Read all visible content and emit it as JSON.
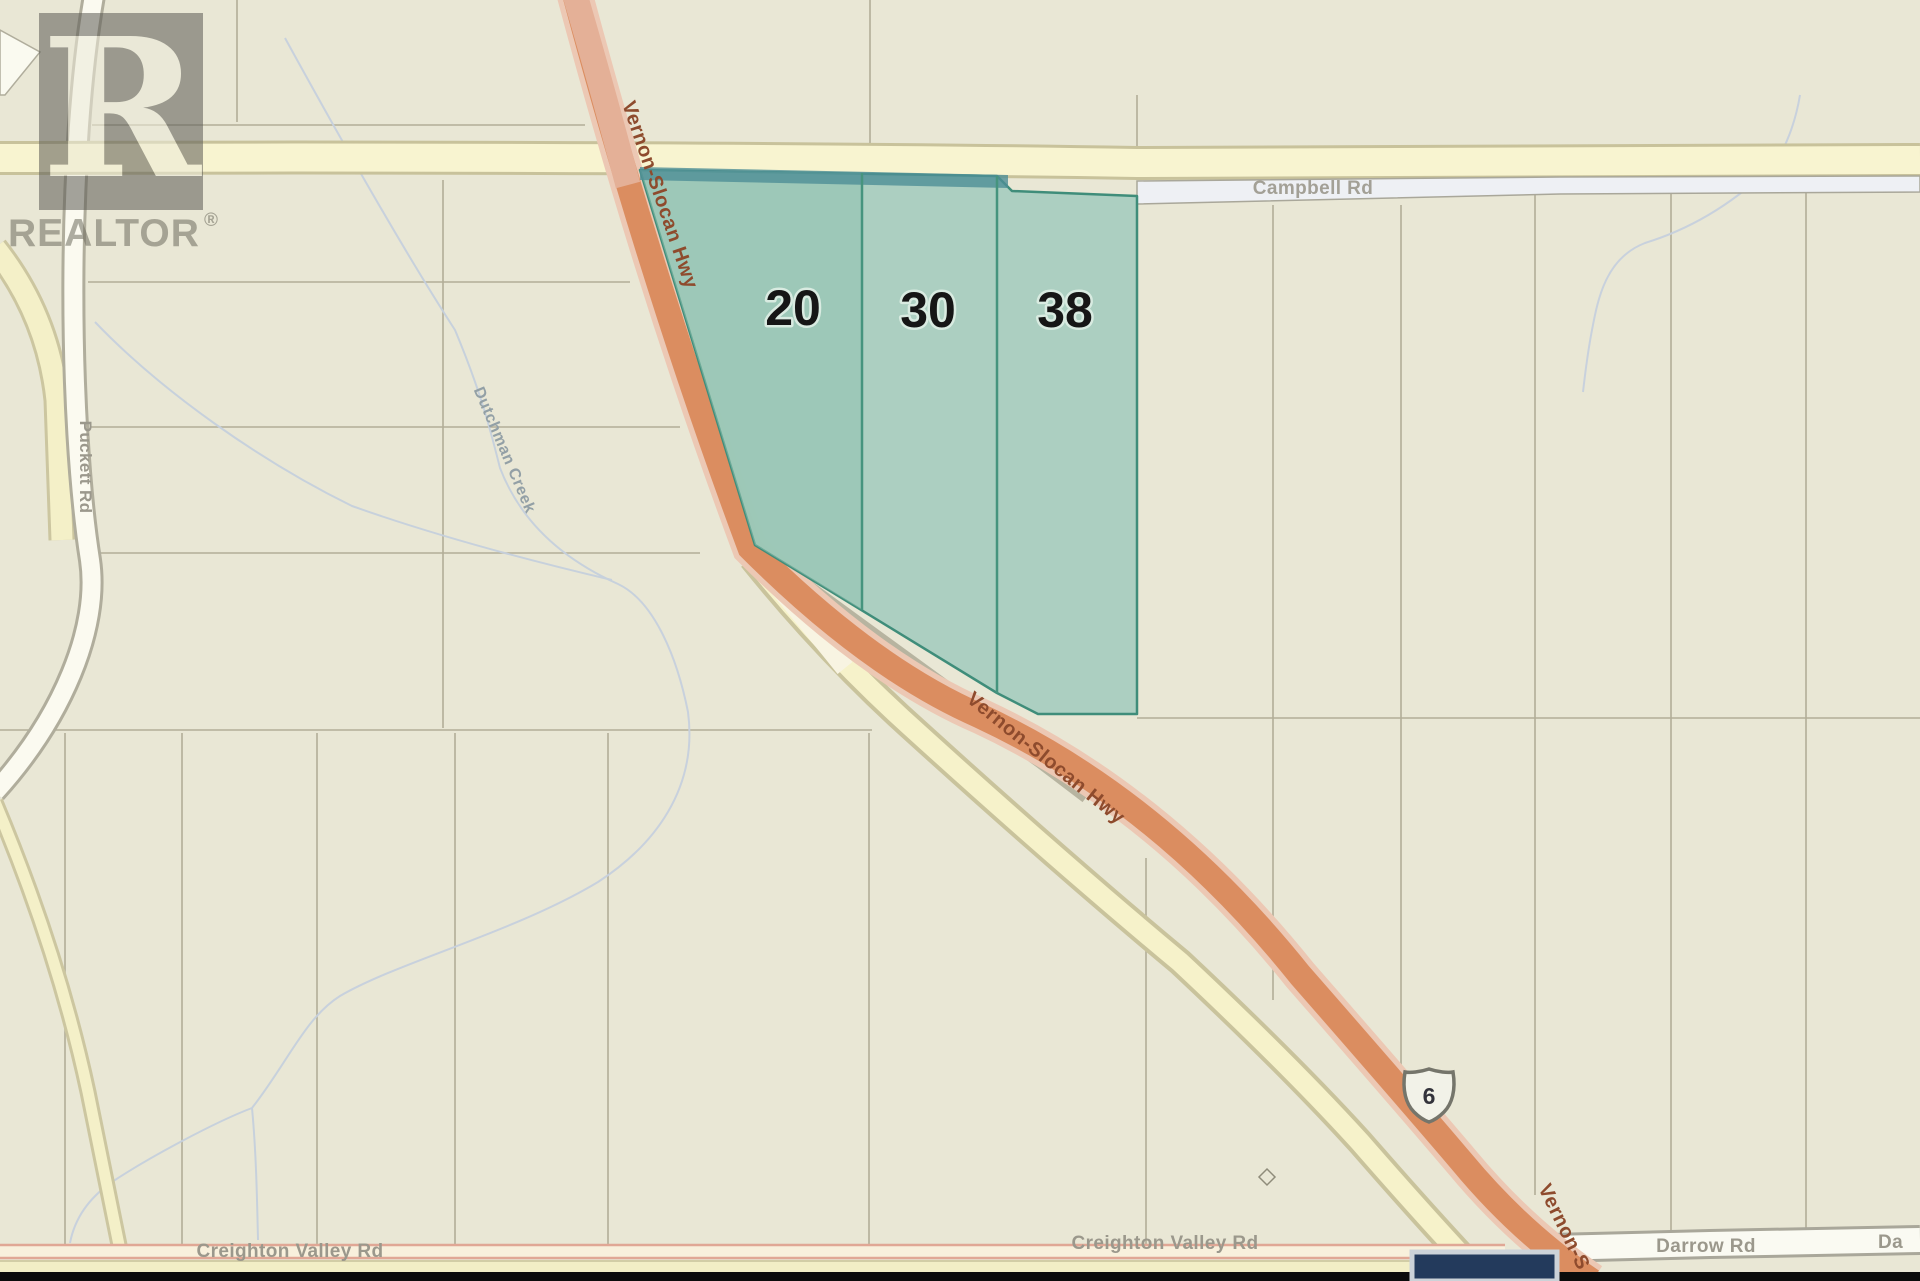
{
  "map": {
    "watermark": {
      "logo_letter": "R",
      "brand": "REALTOR",
      "registered_mark": "®"
    },
    "parcels": {
      "items": [
        {
          "label": "20"
        },
        {
          "label": "30"
        },
        {
          "label": "38"
        }
      ]
    },
    "roads": {
      "campbell": {
        "label": "Campbell Rd"
      },
      "vernon_slocan": {
        "label": "Vernon-Slocan Hwy",
        "label_truncated": "Vernon-S",
        "shield_number": "6"
      },
      "creighton_valley": {
        "label": "Creighton Valley Rd"
      },
      "darrow": {
        "label": "Darrow Rd",
        "label_truncated": "Da"
      },
      "puckett": {
        "label": "Puckett Rd"
      }
    },
    "waterways": {
      "dutchman_creek": {
        "label": "Dutchman Creek"
      }
    },
    "colors": {
      "background": "#e9e7d5",
      "parcel_fill": "#a9cec0",
      "parcel_outline": "#3f8d7a",
      "parcel_top_strip": "#4f8f96",
      "highway_fill": "#db8d60",
      "highway_casing": "#ecc8b4",
      "minor_road_yellow": "#f6f2ca",
      "white_road": "#fafaf2",
      "creek": "#c6d0dd",
      "lot_line": "#b2ae98",
      "label_gray": "#9b988c",
      "highway_label": "#8e4b2d",
      "marker_navy": "#233a5c"
    }
  }
}
